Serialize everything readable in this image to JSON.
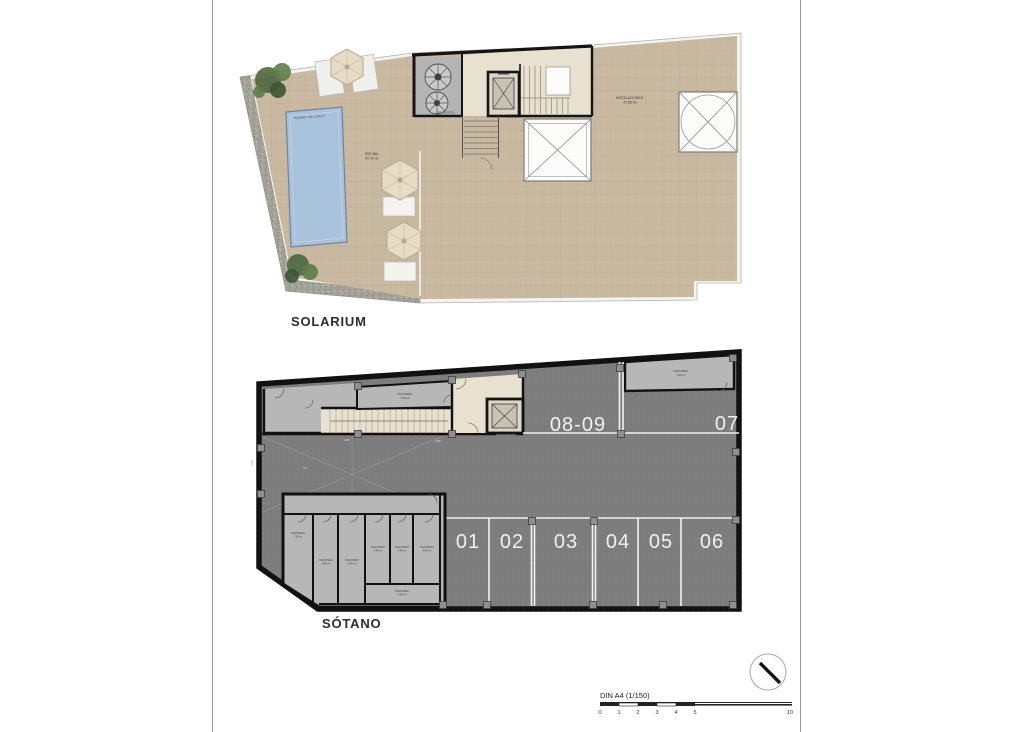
{
  "sheet": {
    "scale_label": "DIN A4 (1/150)",
    "scale_ticks": [
      "0",
      "1",
      "2",
      "3",
      "4",
      "5",
      "10"
    ]
  },
  "solarium": {
    "title": "SOLARIUM",
    "pool_edge_label": "PISCINA 7.50 x 3.00 m",
    "pool_name": "PISCINA",
    "pool_area": "42.40 m²",
    "deposits_label": "DEPOSITOS",
    "installations_name": "INSTALACIONES",
    "installations_area": "47.56 m²"
  },
  "sotano": {
    "title": "SÓTANO",
    "parking_bottom": [
      "01",
      "02",
      "03",
      "04",
      "05",
      "06"
    ],
    "parking_top": [
      "08-09",
      "07"
    ],
    "trastero_top_middle": {
      "name": "TRASTERO",
      "area": "7.60 m²"
    },
    "trastero_top_right": {
      "name": "TRASTERO",
      "area": "7.20 m²"
    },
    "trasteros": [
      {
        "name": "TRASTERO",
        "area": "7.30 m²"
      },
      {
        "name": "TRASTERO",
        "area": "5.80 m²"
      },
      {
        "name": "TRASTERO",
        "area": "5.35 m²"
      },
      {
        "name": "TRASTERO",
        "area": "3.90 m²"
      },
      {
        "name": "TRASTERO",
        "area": "3.90 m²"
      },
      {
        "name": "TRASTERO",
        "area": "3.90 m²"
      },
      {
        "name": "TRASTERO",
        "area": "4.80 m²"
      }
    ],
    "ramp_dims": {
      "top": "4.45",
      "right": "5.00",
      "left": "5.50",
      "slope": "5%"
    }
  },
  "colors": {
    "terrace": "#c8b9a0",
    "pool": "#a9c2dc",
    "parking": "#7d7d7d",
    "storage": "#b7b7b7",
    "cream": "#e9e1d0",
    "wall": "#141414"
  }
}
